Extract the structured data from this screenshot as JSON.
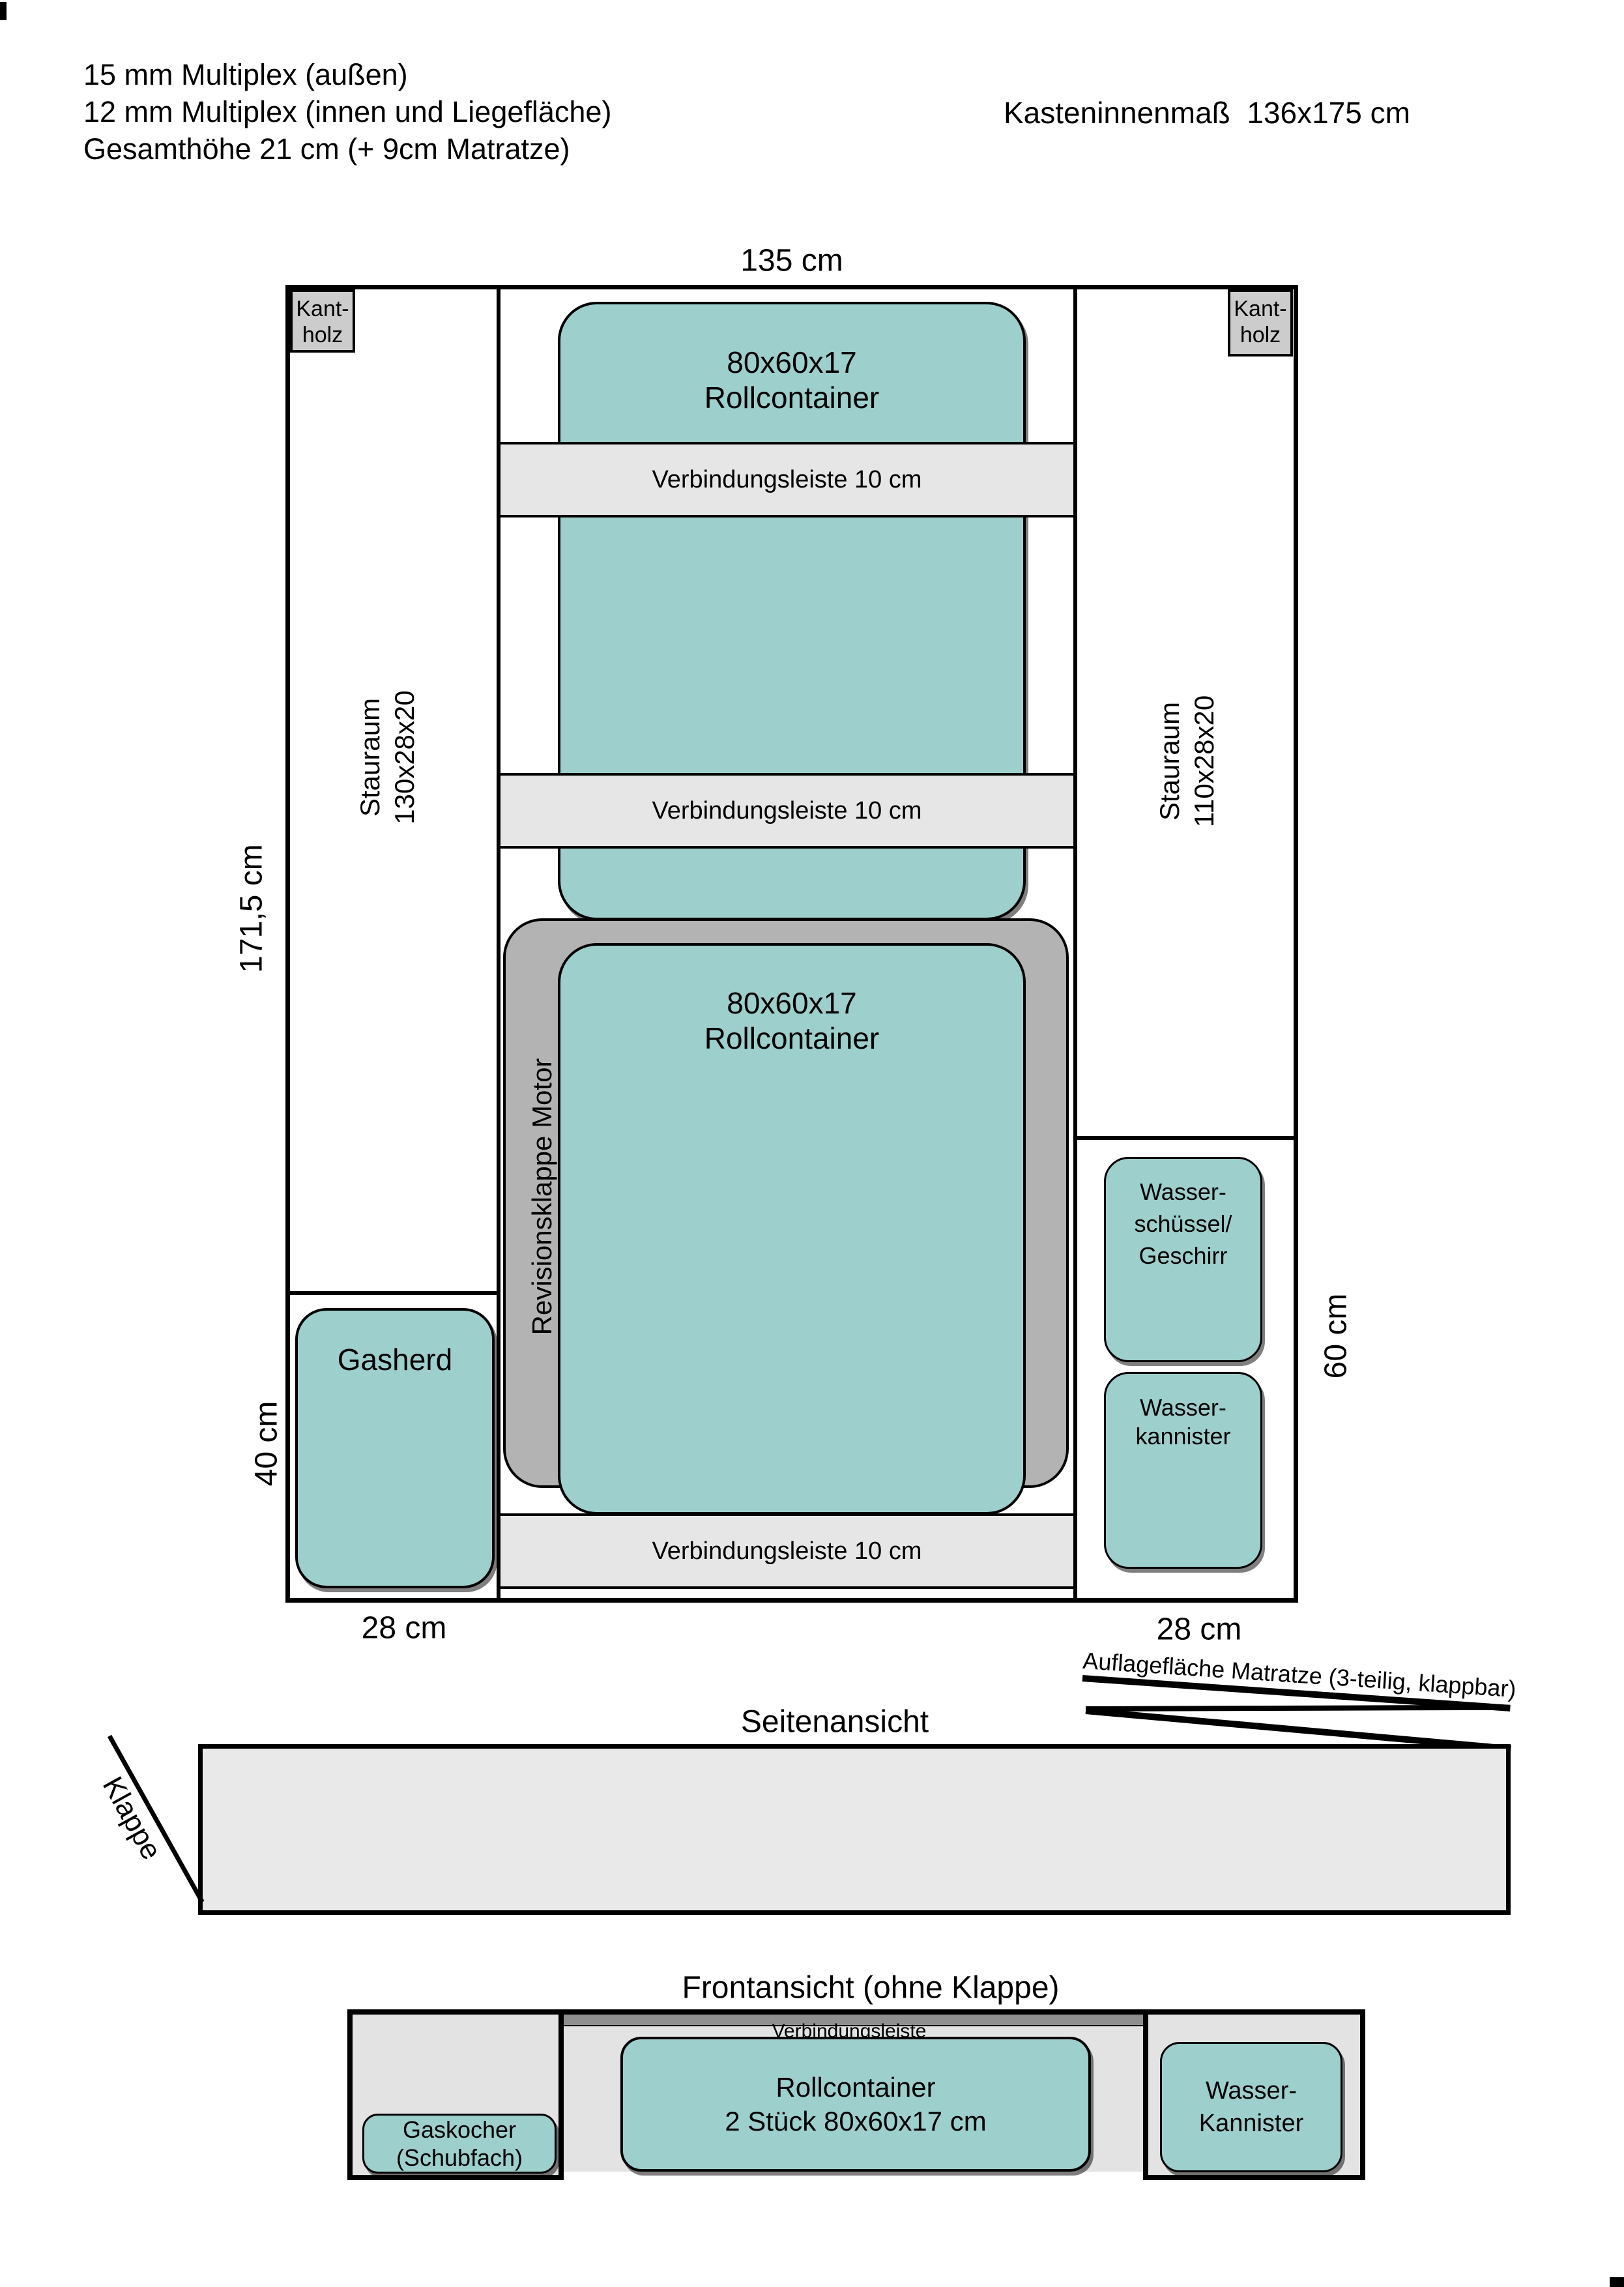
{
  "colors": {
    "teal": "#9dcfcc",
    "plate_grey": "#b3b3b3",
    "kantholz_grey": "#cccccc",
    "strip_grey": "#e6e6e6",
    "panel_grey": "#e3e3e3",
    "side_grey": "#e9e9e9",
    "dark_bar": "#8f8f8f",
    "ink": "#000000"
  },
  "header": {
    "line1": "15 mm Multiplex (außen)",
    "line2": "12 mm Multiplex (innen und Liegefläche)",
    "line3": "Gesamthöhe 21 cm (+ 9cm Matratze)",
    "kasten": "Kasteninnenmaß  136x175 cm"
  },
  "plan": {
    "dim_width": "135 cm",
    "dim_height": "171,5 cm",
    "dim_40": "40 cm",
    "dim_60": "60 cm",
    "dim_28_left": "28 cm",
    "dim_28_right": "28 cm",
    "kantholz": {
      "line1": "Kant-",
      "line2": "holz"
    },
    "stauraum_left": {
      "line1": "Stauraum",
      "line2": "130x28x20"
    },
    "stauraum_right": {
      "line1": "Stauraum",
      "line2": "110x28x20"
    },
    "rollcontainer": {
      "line1": "80x60x17",
      "line2": "Rollcontainer"
    },
    "verbindungsleiste": "Verbindungsleiste 10 cm",
    "revisionsklappe": "Revisionsklappe Motor",
    "gasherd": "Gasherd",
    "wasserschuessel": {
      "line1": "Wasser-",
      "line2": "schüssel/",
      "line3": "Geschirr"
    },
    "wasserkannister": {
      "line1": "Wasser-",
      "line2": "kannister"
    }
  },
  "side": {
    "title": "Seitenansicht",
    "klappe": "Klappe",
    "auflage": "Auflagefläche Matratze (3-teilig, klappbar)"
  },
  "front": {
    "title": "Frontansicht (ohne Klappe)",
    "verbindungsleiste": "Verbindungsleiste",
    "gaskocher": {
      "line1": "Gaskocher",
      "line2": "(Schubfach)"
    },
    "rollcontainer": {
      "line1": "Rollcontainer",
      "line2": "2 Stück 80x60x17 cm"
    },
    "kannister": {
      "line1": "Wasser-",
      "line2": "Kannister"
    }
  }
}
